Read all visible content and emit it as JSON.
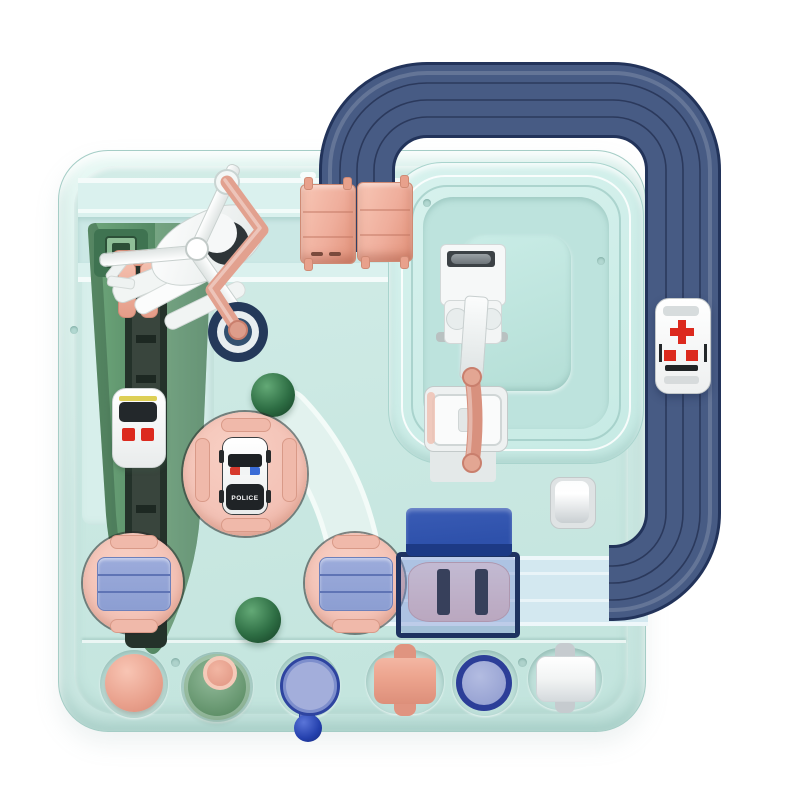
{
  "scene": {
    "description": "Top-down product photo of a pastel mint children's rescue-car adventure track toy board with a navy overhead loop track, ambulance, police car, helicopter, launch ramp, rotary route dials, crane elevator, tunnel garage and a row of six chunky action buttons along the bottom."
  },
  "labels": {
    "police": "POLICE"
  },
  "symbols": {
    "ambulance_marking": "red-cross"
  },
  "components": [
    "game-board",
    "overhead-loop-track",
    "top-feed-track",
    "inner-loop-plateau",
    "bottom-road-track",
    "pink-gate-left",
    "pink-gate-right",
    "helicopter",
    "launch-ramp",
    "train-car",
    "pink-lever",
    "rotary-knob",
    "green-dome-upper",
    "green-dome-lower",
    "police-turntable",
    "police-car",
    "route-dial-left",
    "route-dial-right",
    "crane-mechanism",
    "elevator-tray",
    "pink-pipe",
    "white-roller-button",
    "tunnel-garage",
    "pink-car",
    "ambulance-car",
    "button-pink-dome",
    "button-green-funnel",
    "button-blue-paddle",
    "button-pink-roller",
    "button-blue-round",
    "button-white-roller"
  ],
  "palette": {
    "mint": "#cfe9e4",
    "navy": "#475b84",
    "navydark": "#22335a",
    "salmon": "#efae9c",
    "turnpink": "#f3c2b6",
    "periwinkle": "#8c9ed2",
    "royal": "#2e51ab",
    "red": "#dc2a1e",
    "dome": "#2e6e44",
    "ball": "#2440ad"
  }
}
